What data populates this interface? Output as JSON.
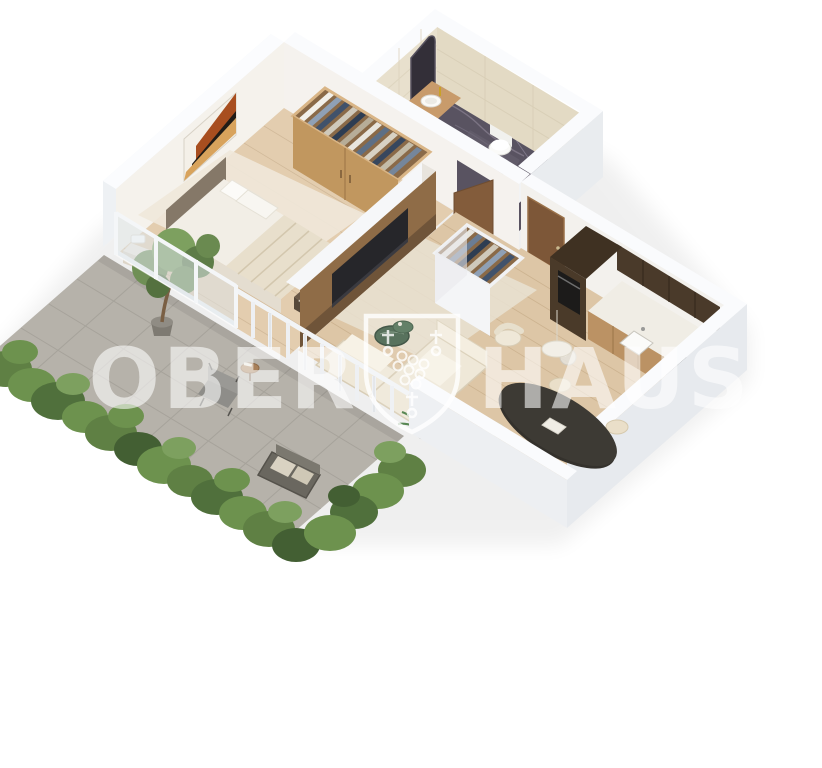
{
  "watermark": {
    "brand_left": "OBER",
    "brand_right": "HAUS",
    "logo": "ober-haus-crest-shield"
  },
  "scene": {
    "type": "isometric-3d-floor-plan",
    "rooms": [
      "bedroom",
      "bathroom",
      "hallway",
      "kitchen",
      "living-room",
      "dining-area",
      "terrace-garden"
    ],
    "palette": {
      "background": "#ffffff",
      "wall_white": "#f0f2f5",
      "wall_warm_inner": "#f5f2ec",
      "wood_floor": "#ddc6a6",
      "bathroom_tile": "#e8e0cd",
      "bathroom_marble_floor": "#595361",
      "terrace_tile": "#b6b2aa",
      "hedge_green": "#5f8044",
      "kitchen_dark_cabinet": "#4a3a2a",
      "wood_furniture": "#c1975f",
      "upholstery_cream": "#efe8d8",
      "dining_table_dark": "#34312c",
      "door_brown": "#7d5738"
    }
  }
}
